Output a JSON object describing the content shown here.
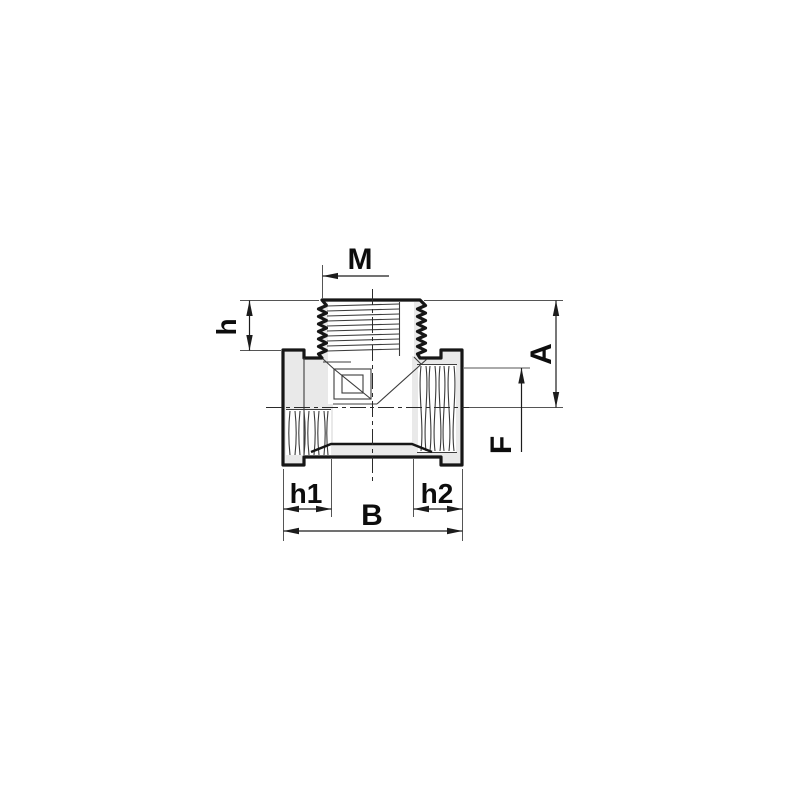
{
  "drawing": {
    "title": "Threaded tee pipe fitting — sectioned side view with dimensions",
    "labels": {
      "thread_top": "M",
      "height_left": "h",
      "height_right": "A",
      "bore_right": "F",
      "depth_left": "h1",
      "depth_right": "h2",
      "width_overall": "B"
    },
    "colors": {
      "background": "#ffffff",
      "body_fill": "#e9e9e9",
      "outline": "#161616",
      "detail_line": "#3c3c3c",
      "extension_line": "#555555",
      "dimension_line": "#1c1c1c",
      "label_text": "#0d0d0d"
    }
  }
}
